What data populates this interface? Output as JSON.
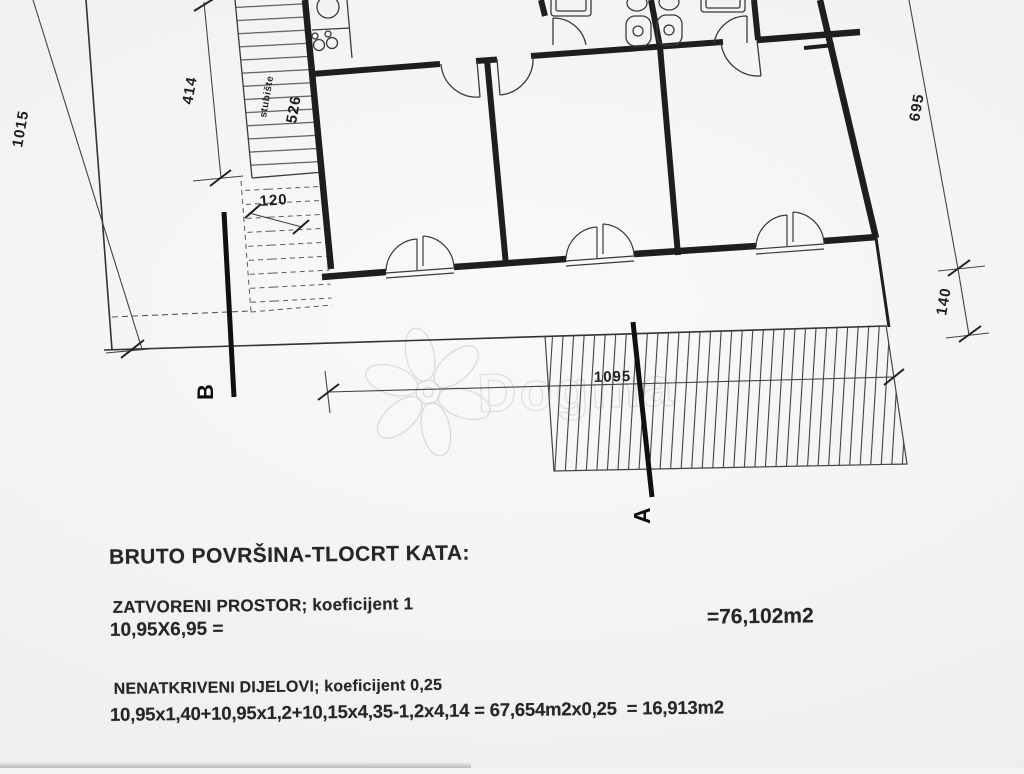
{
  "watermark": {
    "brand": "Dogma"
  },
  "plan": {
    "dimensions": {
      "left_height": "1015",
      "stairs_height": "414",
      "stairs_label": "stubište",
      "stairs_inner": "526",
      "landing_width": "120",
      "right_height": "695",
      "right_lower": "140",
      "bottom_width": "1095"
    },
    "section_markers": {
      "a": "A",
      "b": "B"
    }
  },
  "calc": {
    "title": "BRUTO POVRŠINA-TLOCRT KATA:",
    "closed_label": "ZATVORENI PROSTOR; koeficijent 1",
    "closed_formula": "10,95X6,95 =",
    "closed_result": "=76,102m2",
    "open_label": "NENATKRIVENI DIJELOVI; koeficijent 0,25",
    "open_formula": "10,95x1,40+10,95x1,2+10,15x4,35-1,2x4,14 = 67,654m2x0,25  = 16,913m2"
  },
  "colors": {
    "ink": "#222222",
    "paper": "#f4f3f1",
    "dim_line": "#444444",
    "watermark": "#c4c4c2"
  }
}
